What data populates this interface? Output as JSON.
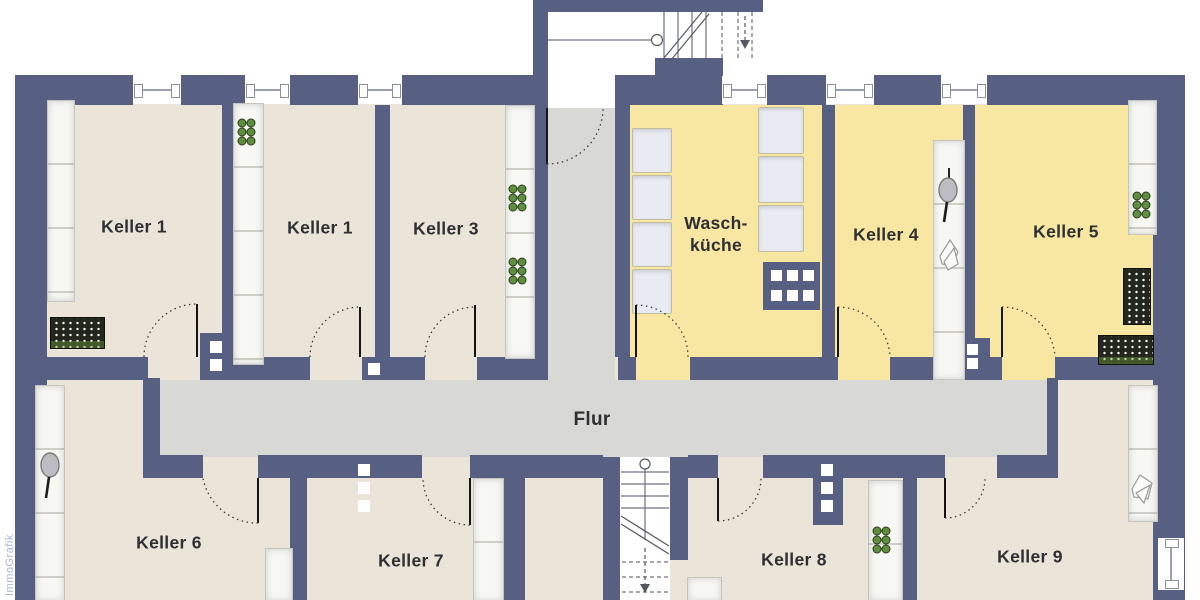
{
  "plan": {
    "watermark": "ImmoGrafik",
    "hall_label": "Flur",
    "rooms": [
      {
        "id": "keller-1a",
        "label": "Keller 1"
      },
      {
        "id": "keller-1b",
        "label": "Keller 1"
      },
      {
        "id": "keller-3",
        "label": "Keller 3"
      },
      {
        "id": "waschkueche",
        "label_line1": "Wasch-",
        "label_line2": "küche"
      },
      {
        "id": "keller-4",
        "label": "Keller 4"
      },
      {
        "id": "keller-5",
        "label": "Keller 5"
      },
      {
        "id": "keller-6",
        "label": "Keller 6"
      },
      {
        "id": "keller-7",
        "label": "Keller 7"
      },
      {
        "id": "keller-8",
        "label": "Keller 8"
      },
      {
        "id": "keller-9",
        "label": "Keller 9"
      }
    ],
    "colors": {
      "wall": "#575f82",
      "room_floor": "#eae5d8",
      "laundry_floor": "#f8e7a3",
      "hall_floor": "#d8d8d5",
      "bottle_green": "#5f8f3e",
      "label_text": "#2d2f33"
    }
  }
}
